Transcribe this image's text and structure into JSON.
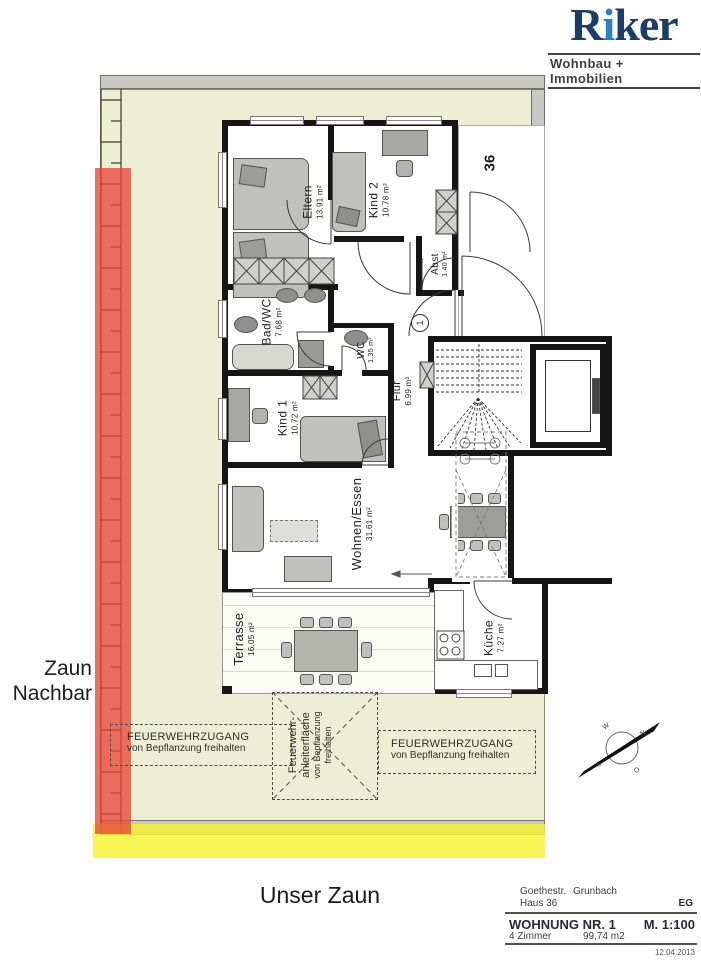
{
  "logo": {
    "brand_r": "R",
    "brand_i": "i",
    "brand_rest": "ker",
    "tagline": "Wohnbau + Immobilien"
  },
  "plan": {
    "house_number": "36",
    "apartment_marker": "1",
    "rooms": [
      {
        "name": "Eltern",
        "area": "13.91 m²"
      },
      {
        "name": "Kind 2",
        "area": "10.78 m²"
      },
      {
        "name": "Abst",
        "area": "1.40 m²"
      },
      {
        "name": "Bad/WC",
        "area": "7.68 m²"
      },
      {
        "name": "WC",
        "area": "1.35 m²"
      },
      {
        "name": "Flur",
        "area": "6.99 m²"
      },
      {
        "name": "Kind 1",
        "area": "10.72 m²"
      },
      {
        "name": "Wohnen/Essen",
        "area": "31.61 m²"
      },
      {
        "name": "Küche",
        "area": "7.27 m²"
      },
      {
        "name": "Terrasse",
        "area": "16.05 m²"
      }
    ]
  },
  "annotations": {
    "zaun_nachbar_line1": "Zaun",
    "zaun_nachbar_line2": "Nachbar",
    "unser_zaun": "Unser Zaun",
    "fire_access_title": "FEUERWEHRZUGANG",
    "fire_access_sub": "von Bepflanzung freihalten",
    "ladder_line1": "Feuerwehr-",
    "ladder_line2": "anleiterfläche",
    "ladder_line3": "von Bepflanzung",
    "ladder_line4": "freihalten"
  },
  "compass": {
    "n": "N",
    "e": "O",
    "s": "S",
    "w": "W"
  },
  "title_block": {
    "street": "Goethestr.",
    "city": "Grunbach",
    "house": "Haus 36",
    "floor": "EG",
    "unit": "WOHNUNG NR. 1",
    "scale": "M. 1:100",
    "rooms": "4 Zimmer",
    "area": "99,74 m2",
    "date": "12.04.2013"
  },
  "colors": {
    "lot_green": "#edefd5",
    "band_gray": "#c9c9c4",
    "highlight_red": "#e8463a",
    "highlight_yellow": "#f7f32d",
    "logo_navy": "#1d3c66",
    "logo_blue": "#2e7fc2",
    "wall_black": "#161616"
  }
}
